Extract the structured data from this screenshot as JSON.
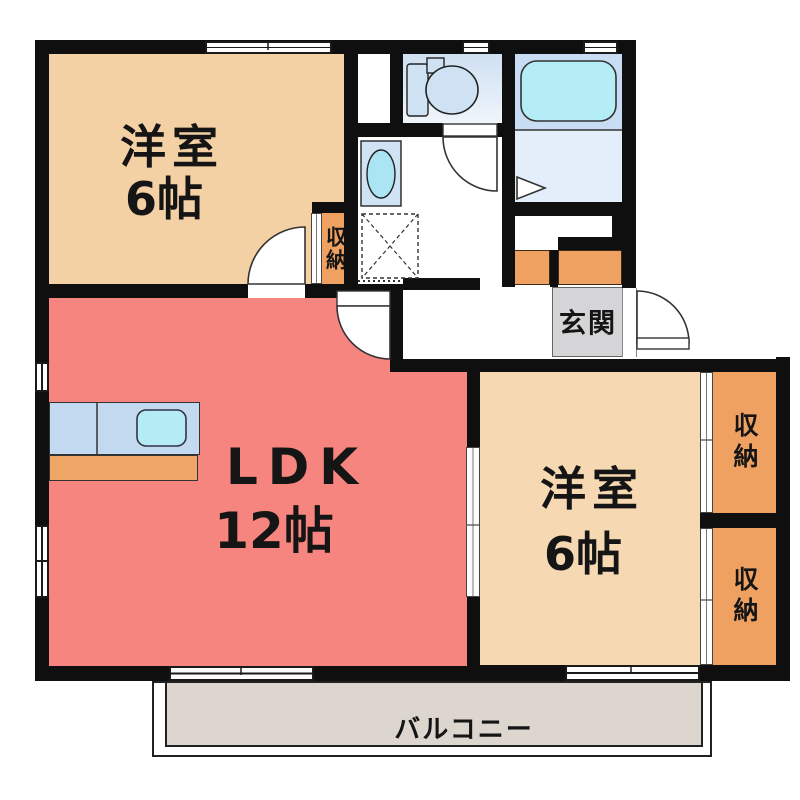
{
  "rooms": {
    "west_room_top": {
      "name": "洋室",
      "size": "6帖"
    },
    "ldk": {
      "name": "LDK",
      "size": "12帖"
    },
    "west_room_right": {
      "name": "洋室",
      "size": "6帖"
    },
    "entrance": {
      "label": "玄関"
    },
    "balcony": {
      "label": "バルコニー"
    }
  },
  "closets": {
    "west_room_closet": {
      "label": "収納"
    },
    "right_closet_top": {
      "label": "収納"
    },
    "right_closet_bottom": {
      "label": "収納"
    }
  },
  "fixtures": [
    "toilet",
    "bathtub",
    "vanity-sink",
    "kitchen-sink-counter",
    "washing-machine-pan",
    "entrance-door",
    "room-doors",
    "sliding-windows",
    "folding-bath-door"
  ],
  "colors": {
    "wall": "#0f0f0f",
    "room_peach": "#f4d0a5",
    "room_peach_light": "#f6d8b3",
    "ldk_salmon": "#f5857e",
    "closet_orange": "#efa161",
    "entrance_gray": "#d5d4d6",
    "balcony_gray": "#dcd6cf",
    "bath_upper_blue": "#c8ddf3",
    "bath_floor_blue": "#e3eefa",
    "toilet_floor_blue": "#dfe9f7",
    "counter_blue": "#c2d9f0",
    "counter_orange": "#efa565",
    "water_cyan": "#b4ebf5",
    "fixture_blue": "#cfe2f4"
  }
}
